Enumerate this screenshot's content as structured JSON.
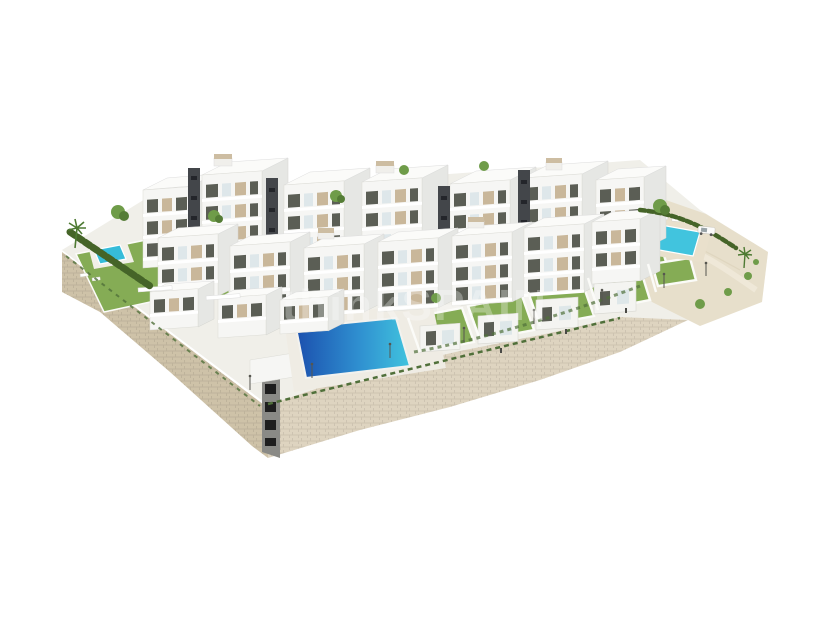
{
  "scene": {
    "type": "3d-architectural-aerial-render",
    "subject": "modern hillside residential complex on a stone podium",
    "background_color": "#ffffff",
    "watermark": {
      "text": "thinkSPAIN",
      "color": "#ffffff",
      "opacity": "0.30"
    }
  },
  "palette": {
    "building_front": "#f6f6f4",
    "building_side": "#e6e7e4",
    "building_roof": "#fbfbf9",
    "facade_panel_beige": "#c9b79a",
    "window_dark": "#5b5e55",
    "tower_dark": "#43464a",
    "glass_balustrade": "#d9e4e8",
    "lawn_green": "#85ac55",
    "hedge_green": "#456428",
    "vine_green": "#50703a",
    "tree_green": "#6f9c49",
    "tree_green_dark": "#557d36",
    "pool_deep_blue": "#1b50ae",
    "pool_turquoise": "#41c4de",
    "pool_small": "#36bcd9",
    "stone_wall_light": "#ded4c0",
    "stone_wall_shaded": "#cec2a8",
    "sand_terrain": "#e7dfcb",
    "pavement": "#f0efe9",
    "pool_deck": "#efece4",
    "corner_stair_grey": "#8a8a86",
    "stair_opening_black": "#1e1e1e",
    "car_white": "#fbfbfa"
  },
  "features": {
    "main_pool": "large communal infinity pool",
    "left_pool": "private corner-garden pool",
    "right_pool": "upper communal pool",
    "retaining_wall": "stone retaining wall podium",
    "gardens": "private lawned gardens",
    "car": "white parked car",
    "trees": "palm trees and shrubs"
  }
}
